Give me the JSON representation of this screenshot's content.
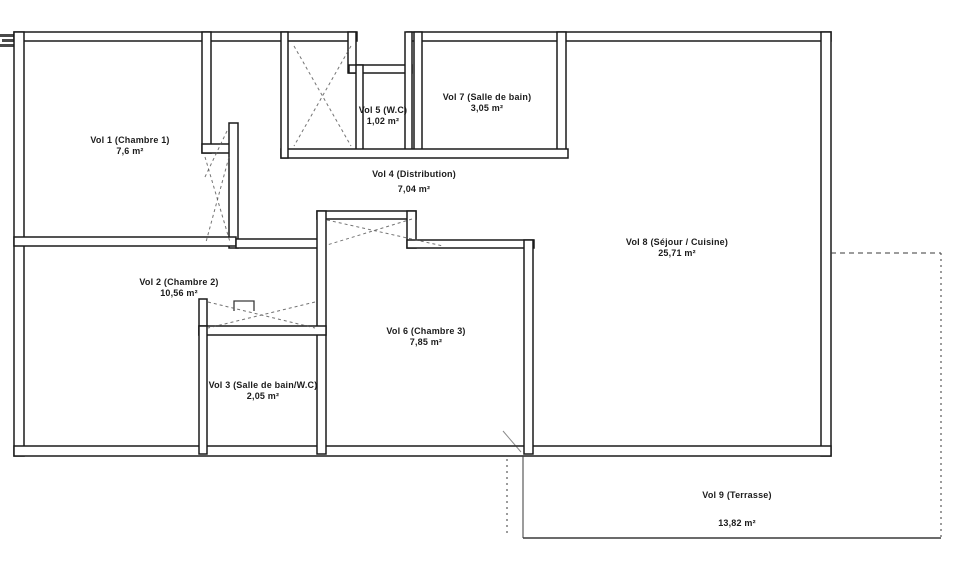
{
  "document_title": "Floor plan with room volumes",
  "rooms": [
    {
      "id": "vol-1",
      "name": "Vol 1 (Chambre 1)",
      "area": "7,6 m²"
    },
    {
      "id": "vol-2",
      "name": "Vol 2 (Chambre 2)",
      "area": "10,56 m²"
    },
    {
      "id": "vol-3",
      "name": "Vol 3 (Salle de bain/W.C)",
      "area": "2,05 m²"
    },
    {
      "id": "vol-4",
      "name": "Vol 4 (Distribution)",
      "area": "7,04 m²"
    },
    {
      "id": "vol-5",
      "name": "Vol 5 (W.C)",
      "area": "1,02 m²"
    },
    {
      "id": "vol-6",
      "name": "Vol 6 (Chambre 3)",
      "area": "7,85 m²"
    },
    {
      "id": "vol-7",
      "name": "Vol 7 (Salle de bain)",
      "area": "3,05 m²"
    },
    {
      "id": "vol-8",
      "name": "Vol 8 (Séjour / Cuisine)",
      "area": "25,71 m²"
    },
    {
      "id": "vol-9",
      "name": "Vol 9 (Terrasse)",
      "area": "13,82 m²"
    }
  ],
  "colors": {
    "wall": "#1b1b1b",
    "dash": "#5a5a5a",
    "paper": "#ffffff"
  }
}
